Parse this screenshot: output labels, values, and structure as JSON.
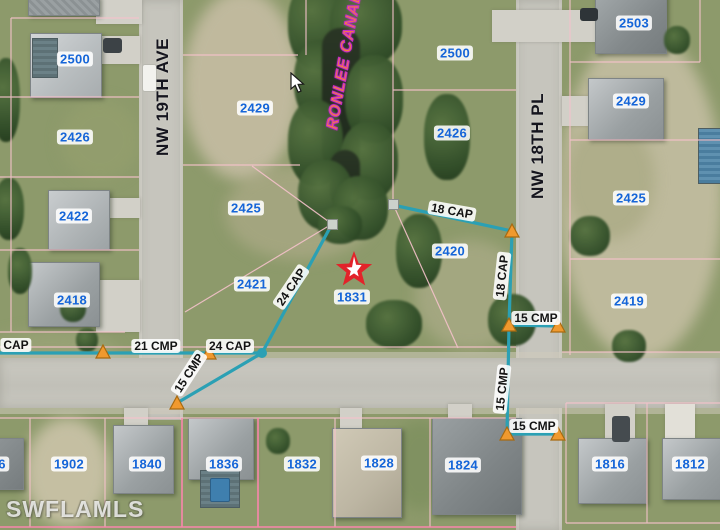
{
  "map": {
    "watermark": "SWFLAMLS",
    "canal": {
      "label": "RONLEE CANAL"
    },
    "streets": [
      {
        "label": "NW 19TH AVE"
      },
      {
        "label": "NW 18TH PL"
      }
    ],
    "subject_parcel": "1831",
    "parcels": [
      {
        "label": "2500"
      },
      {
        "label": "2426"
      },
      {
        "label": "2429"
      },
      {
        "label": "2500"
      },
      {
        "label": "2426"
      },
      {
        "label": "2503"
      },
      {
        "label": "2429"
      },
      {
        "label": "2425"
      },
      {
        "label": "2421"
      },
      {
        "label": "1831"
      },
      {
        "label": "2420"
      },
      {
        "label": "2425"
      },
      {
        "label": "2419"
      },
      {
        "label": "2422"
      },
      {
        "label": "2418"
      },
      {
        "label": "1902"
      },
      {
        "label": "1840"
      },
      {
        "label": "1836"
      },
      {
        "label": "1832"
      },
      {
        "label": "1828"
      },
      {
        "label": "1824"
      },
      {
        "label": "1816"
      },
      {
        "label": "1812"
      },
      {
        "label": "6"
      }
    ],
    "measurements": [
      {
        "label": "18 CAP"
      },
      {
        "label": "18 CAP"
      },
      {
        "label": "24 CAP"
      },
      {
        "label": "24 CAP"
      },
      {
        "label": "21 CMP"
      },
      {
        "label": "CAP"
      },
      {
        "label": "15 CMP"
      },
      {
        "label": "15 CMP"
      },
      {
        "label": "15 CMP"
      },
      {
        "label": "15 CMP"
      }
    ],
    "colors": {
      "parcel_label_text": "#1565d8",
      "boundary_pink": "#f5c2cb",
      "boundary_highlight": "#ff85b0",
      "survey_teal": "#2ba0b4",
      "marker_orange": "#f0992e",
      "star_red": "#e2232a",
      "canal_text_orange": "#f4813e",
      "canal_outline_magenta": "#c92cc9"
    }
  }
}
